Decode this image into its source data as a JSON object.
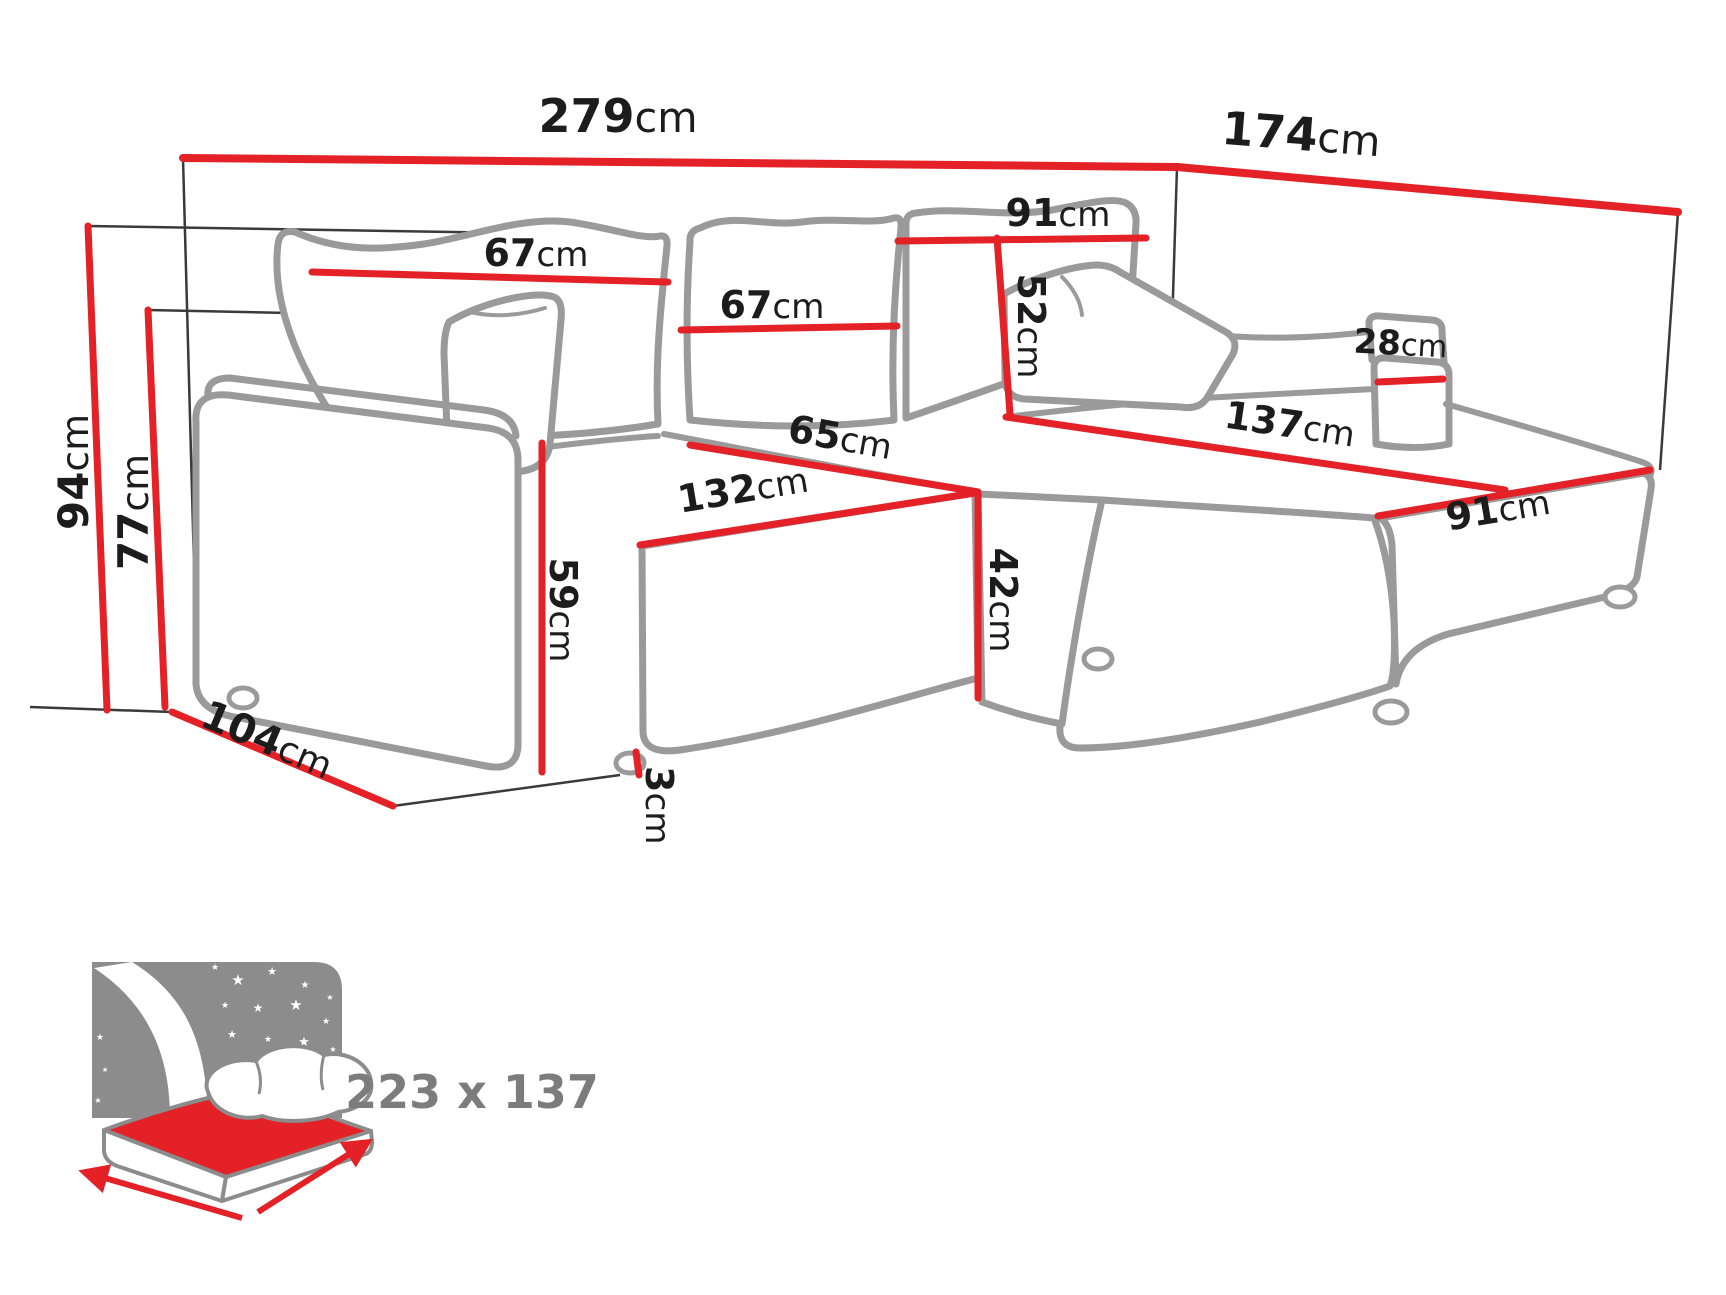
{
  "page": {
    "background": "#ffffff",
    "type": "furniture-dimension-diagram"
  },
  "colors": {
    "dimension_red": "#e32127",
    "sofa_outline": "#9a9a9a",
    "label_text": "#1c1c1c",
    "reference_line": "#3a3a3a",
    "icon_gray": "#8c8c8c",
    "bed_label_gray": "#7c7c7c",
    "star_white": "#ffffff"
  },
  "dimensions": {
    "overall_width": {
      "value": "279",
      "unit": "cm"
    },
    "overall_depth": {
      "value": "174",
      "unit": "cm"
    },
    "overall_height": {
      "value": "94",
      "unit": "cm"
    },
    "frame_height": {
      "value": "77",
      "unit": "cm"
    },
    "front_depth": {
      "value": "104",
      "unit": "cm"
    },
    "back_cushion_left_width": {
      "value": "67",
      "unit": "cm"
    },
    "back_cushion_middle_width": {
      "value": "67",
      "unit": "cm"
    },
    "chaise_backrest_width": {
      "value": "91",
      "unit": "cm"
    },
    "backrest_height": {
      "value": "52",
      "unit": "cm"
    },
    "seat_split_depth": {
      "value": "65",
      "unit": "cm"
    },
    "seat_width": {
      "value": "132",
      "unit": "cm"
    },
    "armrest_height": {
      "value": "59",
      "unit": "cm"
    },
    "seat_height": {
      "value": "42",
      "unit": "cm"
    },
    "leg_height": {
      "value": "3",
      "unit": "cm"
    },
    "chaise_length": {
      "value": "137",
      "unit": "cm"
    },
    "chaise_depth": {
      "value": "91",
      "unit": "cm"
    },
    "chaise_armrest_width": {
      "value": "28",
      "unit": "cm"
    }
  },
  "sleeping_area": {
    "icon": "bed-with-stars-icon",
    "label": "223 x 137"
  },
  "icons": {
    "star": "★"
  }
}
